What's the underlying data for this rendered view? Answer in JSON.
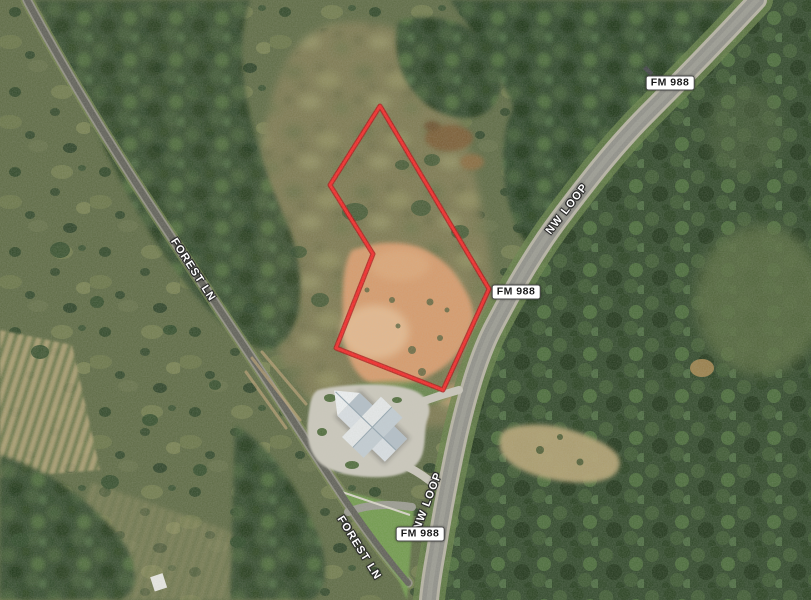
{
  "map": {
    "type": "satellite-aerial-view",
    "labels": {
      "fm988_top": "FM 988",
      "nwloop_mid": "NW LOOP",
      "fm988_mid": "FM 988",
      "nwloop_bottom": "NW LOOP",
      "fm988_bottom": "FM 988",
      "forestln_top": "FOREST LN",
      "forestln_bottom": "FOREST LN"
    },
    "parcel": {
      "points": "380,106 330,185 373,254 336,348 443,390 489,289",
      "stroke_color": "#f42525",
      "halo_color": "#b01212"
    },
    "label_style": {
      "shield_bg": "#ffffff",
      "shield_border": "#4a4a4a",
      "shield_text": "#1a1a1a",
      "road_text": "#ffffff"
    }
  }
}
